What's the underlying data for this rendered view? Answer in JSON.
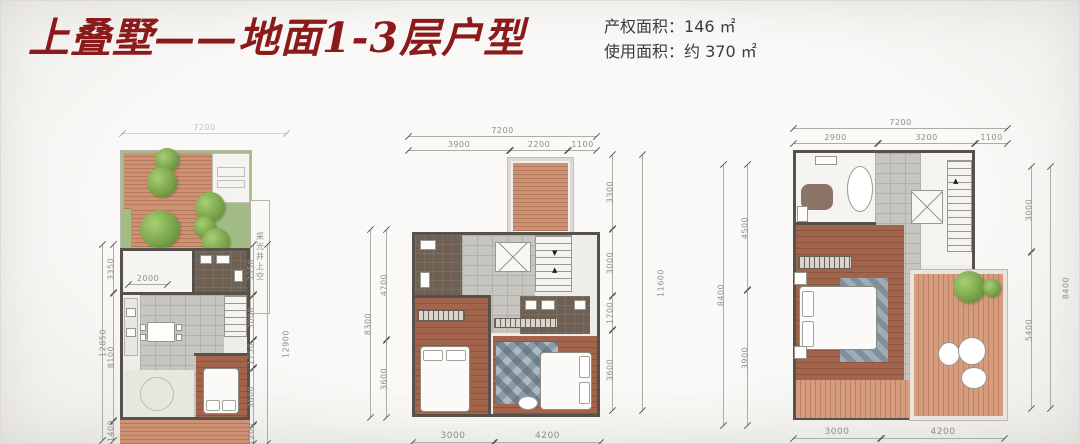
{
  "header": {
    "title": "上叠墅——地面1-3层户型",
    "areas": [
      {
        "label": "产权面积：",
        "value": "146 ㎡"
      },
      {
        "label": "使用面积：",
        "value": "约 370 ㎡"
      }
    ]
  },
  "plan1": {
    "top_overall": "7200",
    "left_overall": "12850",
    "left_dims": [
      "3350",
      "8100",
      "1400"
    ],
    "right_overall": "12900",
    "right_dims": [
      "3350",
      "3000",
      "1750",
      "3600",
      "1200"
    ],
    "inner_dim": "2000",
    "light_well": "采光井上空"
  },
  "plan2": {
    "top_overall": "7200",
    "top_dims": [
      "3900",
      "2200",
      "1100"
    ],
    "left_overall": "8300",
    "left_dims": [
      "4700",
      "3600"
    ],
    "right_overall": "11600",
    "right_dims": [
      "3300",
      "3000",
      "1700",
      "3600"
    ],
    "bottom_dims": [
      "3000",
      "4200"
    ]
  },
  "plan3": {
    "top_overall": "7200",
    "top_dims": [
      "2900",
      "3200",
      "1100"
    ],
    "left_overall": "8400",
    "left_dims": [
      "4500",
      "3900"
    ],
    "right_overall": "8400",
    "right_dims": [
      "3000",
      "5400"
    ],
    "bottom_dims": [
      "3000",
      "4200"
    ]
  }
}
